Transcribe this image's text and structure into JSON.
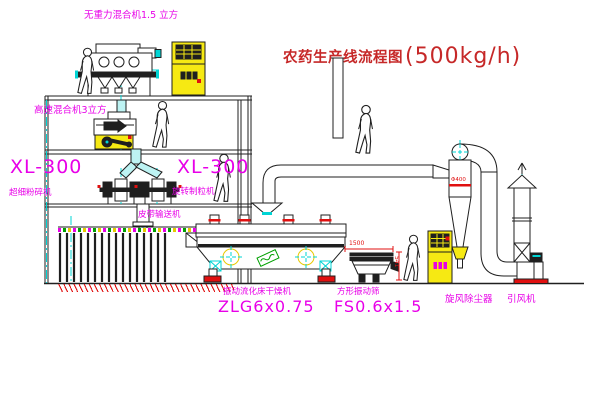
{
  "title": {
    "name": "农药生产线流程图",
    "capacity": "(500kg/h)"
  },
  "equipment_labels": {
    "gravity_free_mixer": "无重力混合机1.5 立方",
    "high_speed_mixer": "高速混合机3立方",
    "pulverizer_model": "XL-300",
    "pulverizer": "超细粉碎机",
    "granulator_model": "XL-300",
    "granulator": "旋转制粒机",
    "belt_conveyor": "皮带输送机",
    "fluid_bed_dryer": "振动流化床干燥机",
    "fluid_bed_dryer_model": "ZLG6x0.75",
    "square_sieve": "方形振动筛",
    "square_sieve_model": "FS0.6x1.5",
    "cyclone": "旋风除尘器",
    "induced_draft_fan": "引风机"
  },
  "dimensions": {
    "sieve_length": "1500",
    "sieve_height": "541",
    "cyclone_diameter": "Φ400"
  },
  "colors": {
    "line": "#1f1f1f",
    "label_magenta": "#e800e8",
    "title_red": "#c62828",
    "accent_red": "#e01010",
    "centerline_cyan": "#00d4d4",
    "equipment_yellow": "#f6e913",
    "tag_green": "#00a000",
    "background": "#ffffff"
  }
}
